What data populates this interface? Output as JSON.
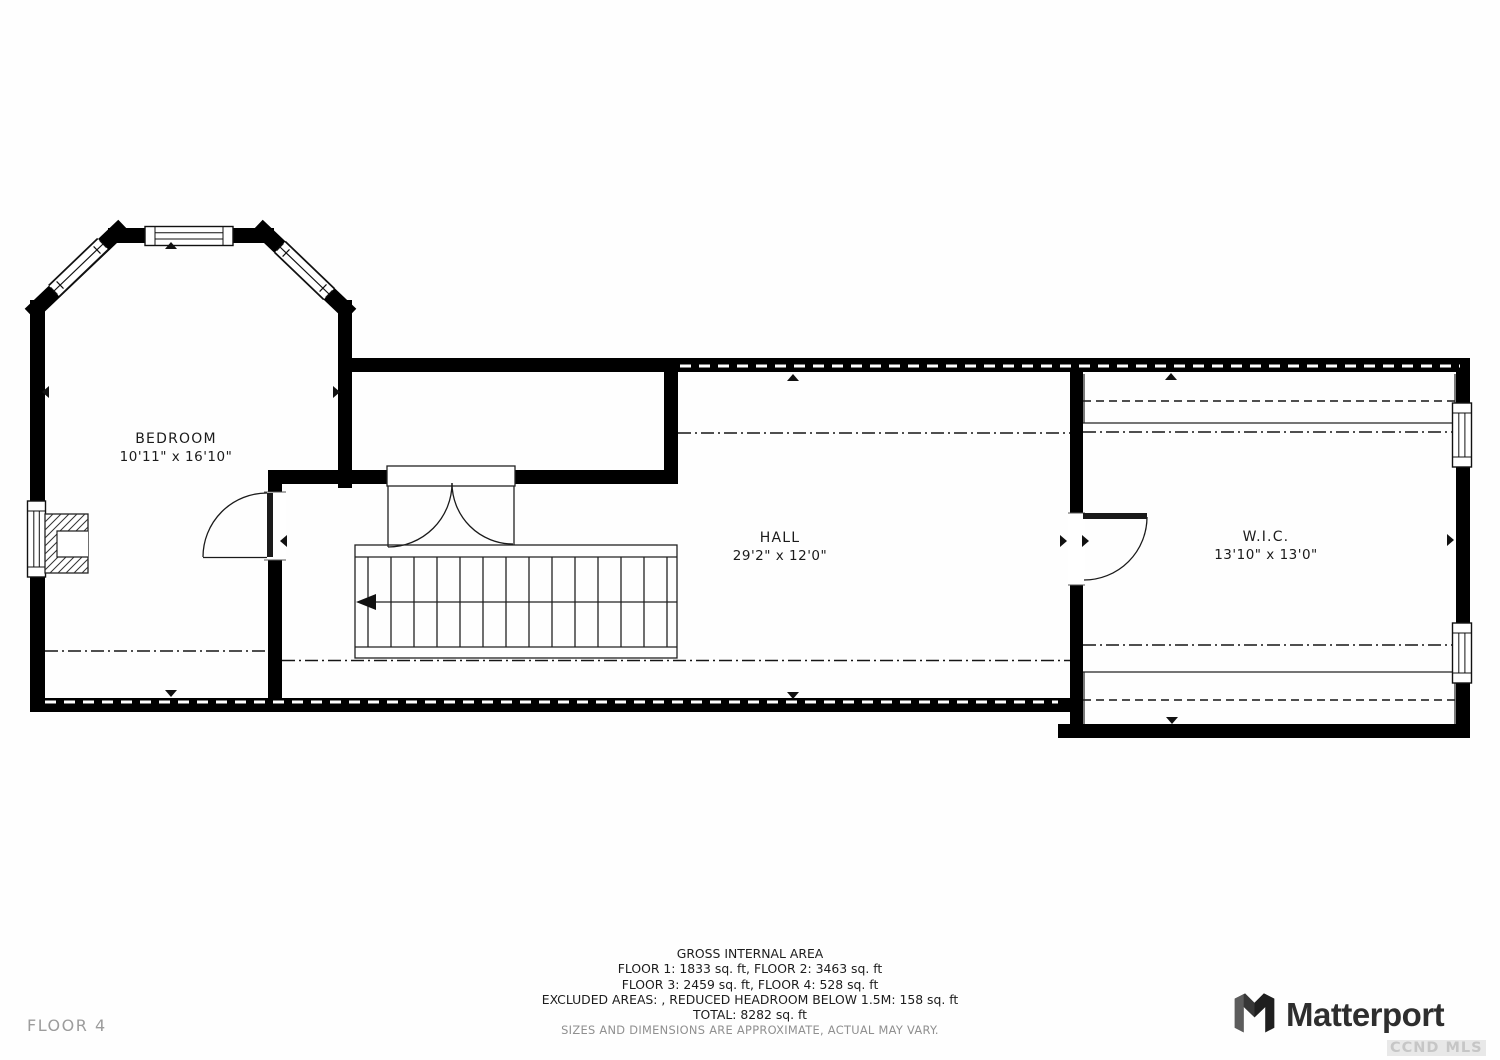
{
  "plan": {
    "rooms": [
      {
        "name": "BEDROOM",
        "dimensions": "10'11\" x 16'10\""
      },
      {
        "name": "HALL",
        "dimensions": "29'2\" x 12'0\""
      },
      {
        "name": "W.I.C.",
        "dimensions": "13'10\" x 13'0\""
      }
    ]
  },
  "footer": {
    "floor_label": "FLOOR 4",
    "area_summary": {
      "title": "GROSS INTERNAL AREA",
      "lines": [
        "FLOOR 1: 1833 sq. ft, FLOOR 2: 3463 sq. ft",
        "FLOOR 3: 2459 sq. ft, FLOOR 4: 528 sq. ft",
        "EXCLUDED AREAS: , REDUCED HEADROOM BELOW 1.5M: 158 sq. ft",
        "TOTAL: 8282 sq. ft"
      ],
      "disclaimer": "SIZES AND DIMENSIONS ARE APPROXIMATE, ACTUAL MAY VARY."
    },
    "brand": {
      "logo_text": "Matterport",
      "watermark": "CCND MLS"
    }
  },
  "colors": {
    "wall": "#000000",
    "line": "#1a1a1a",
    "background": "#ffffff",
    "muted_text": "#9c9c9c",
    "brand_text": "#2e2e2e",
    "watermark_text": "#c6c6c6"
  }
}
